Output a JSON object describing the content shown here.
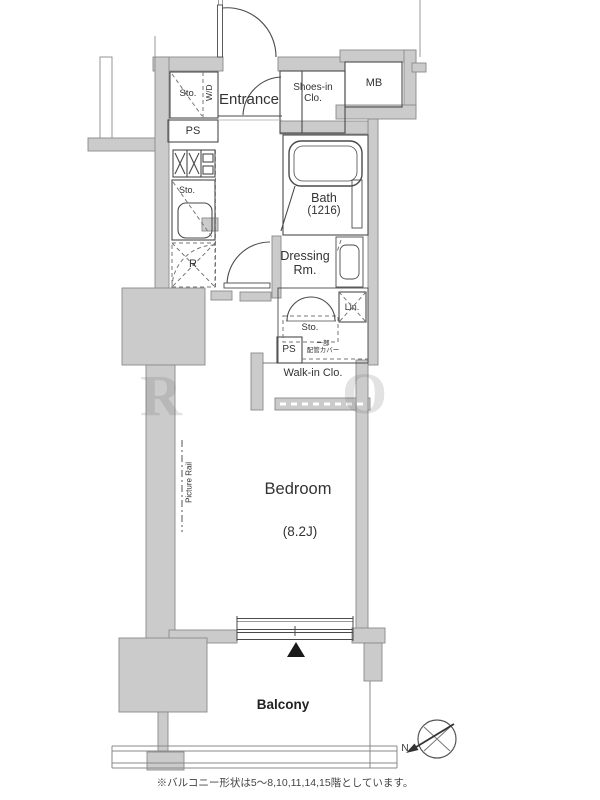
{
  "colors": {
    "wall_fill": "#cbcbcb",
    "wall_edge": "#8a8a8a",
    "line": "#4a4a4a",
    "text": "#333333",
    "marker": "#1a1a1a"
  },
  "rooms": {
    "entrance": "Entrance",
    "shoes_in_closet": "Shoes-in Clo.",
    "meter_box": "MB",
    "storage_top": "Sto.",
    "washer_dryer": "W/D",
    "pipe_space_top": "PS",
    "kitchen_storage": "Sto.",
    "refrigerator": "R",
    "bath_name": "Bath",
    "bath_size": "(1216)",
    "dressing_room": "Dressing Rm.",
    "storage_mid": "Sto.",
    "linen": "Lin.",
    "pipe_space_mid": "PS",
    "pipe_cover_line1": "一部",
    "pipe_cover_line2": "配管カバー",
    "walk_in_closet": "Walk-in Clo.",
    "bedroom_name": "Bedroom",
    "bedroom_size": "(8.2J)",
    "picture_rail": "Picture Rail",
    "balcony": "Balcony"
  },
  "compass": {
    "north_label": "N"
  },
  "watermark": {
    "letter1": "R",
    "letter2": "O"
  },
  "footnote": "※バルコニー形状は5〜8,10,11,14,15階としています。"
}
